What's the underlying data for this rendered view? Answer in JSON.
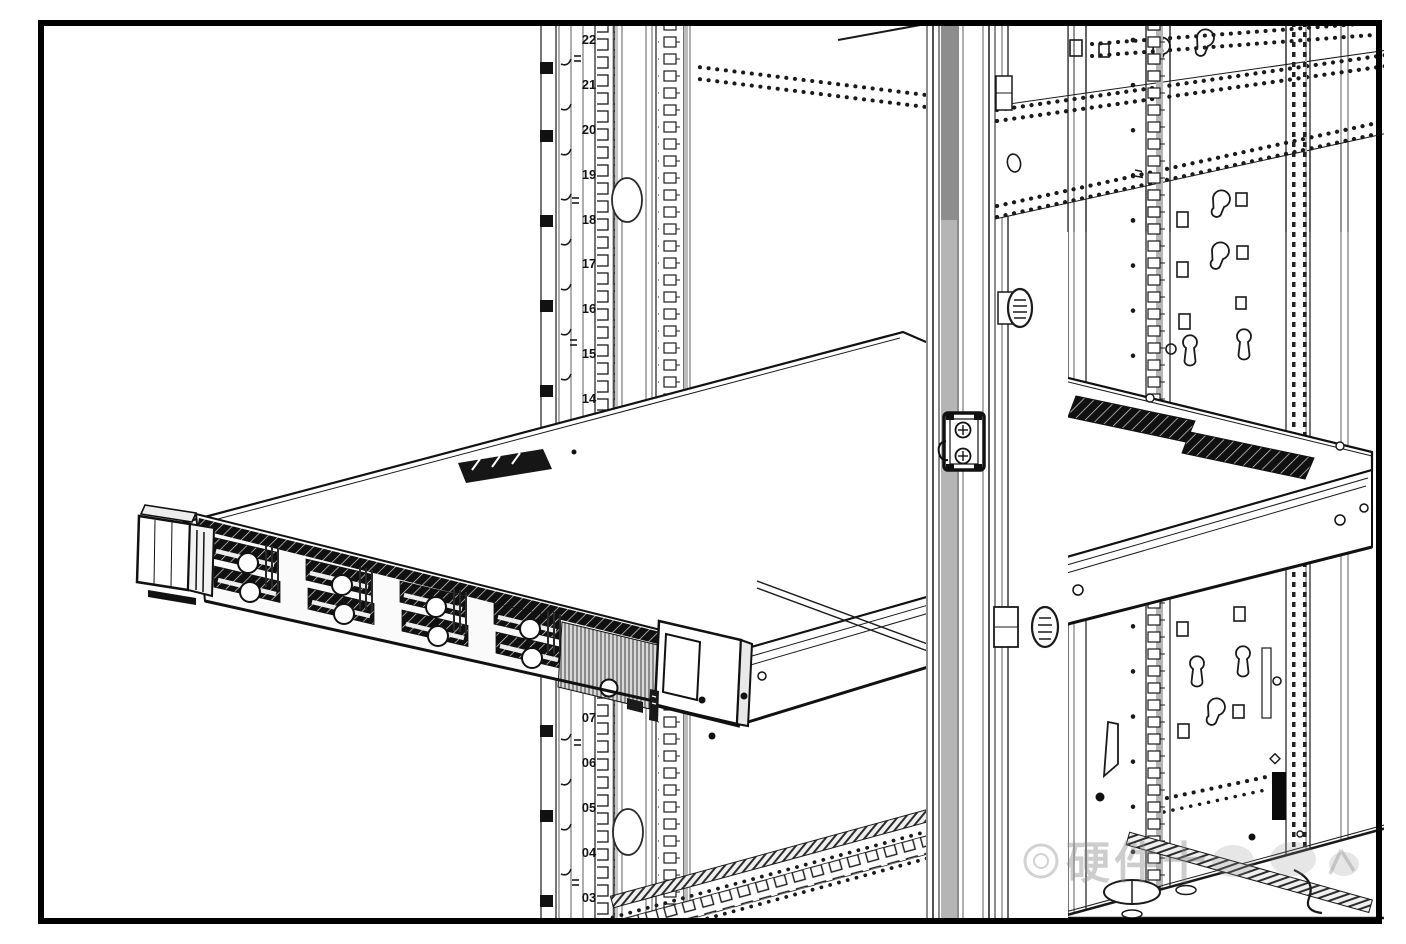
{
  "figure": {
    "rack": {
      "unit_labels_upper": [
        "22",
        "21",
        "20",
        "19",
        "18",
        "17",
        "16",
        "15",
        "14"
      ],
      "unit_labels_lower": [
        "07",
        "06",
        "05",
        "04",
        "03"
      ]
    },
    "watermark": {
      "text": "硬件十"
    },
    "colors": {
      "ink": "#1a1a1a",
      "paper": "#ffffff",
      "rail_gray_dark": "#8d8d8d",
      "rail_gray_light": "#b5b5b5",
      "watermark_gray": "#8a8a8a"
    }
  }
}
